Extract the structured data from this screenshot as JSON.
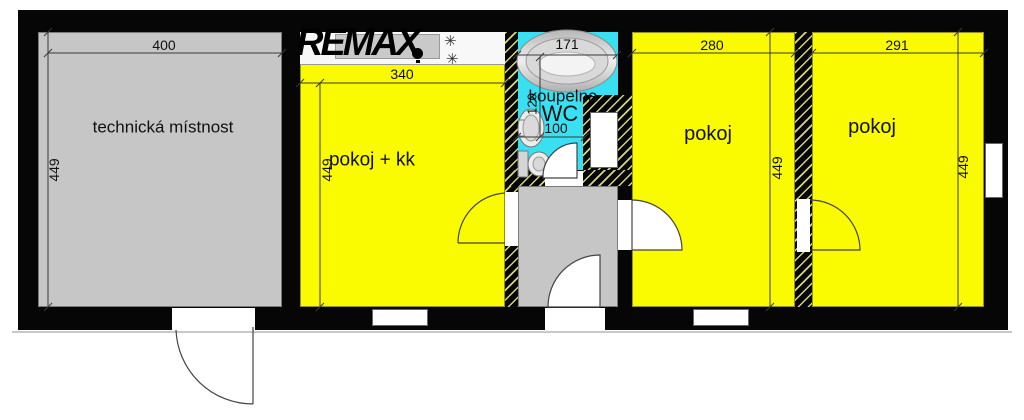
{
  "watermark": {
    "text": "REMAX"
  },
  "rooms": {
    "tech": {
      "label": "technická místnost"
    },
    "kk": {
      "label": "pokoj + kk"
    },
    "bath": {
      "label": "koupelna",
      "wc": "WC"
    },
    "mid": {
      "label": "pokoj"
    },
    "right": {
      "label": "pokoj"
    }
  },
  "dims": {
    "tech_w": "400",
    "tech_h": "449",
    "kk_w": "340",
    "kk_h": "449",
    "bath_w": "171",
    "wc_h": "120",
    "wc_w": "100",
    "mid_w": "280",
    "mid_h": "449",
    "right_w": "291",
    "right_h": "449"
  },
  "icons": {
    "burner": "✳"
  },
  "colors": {
    "room_yellow": "#fafa00",
    "room_gray": "#c6c6c6",
    "bath_cyan": "#39e0f2",
    "wall": "#060606",
    "hatch_line": "#d6d67e"
  }
}
